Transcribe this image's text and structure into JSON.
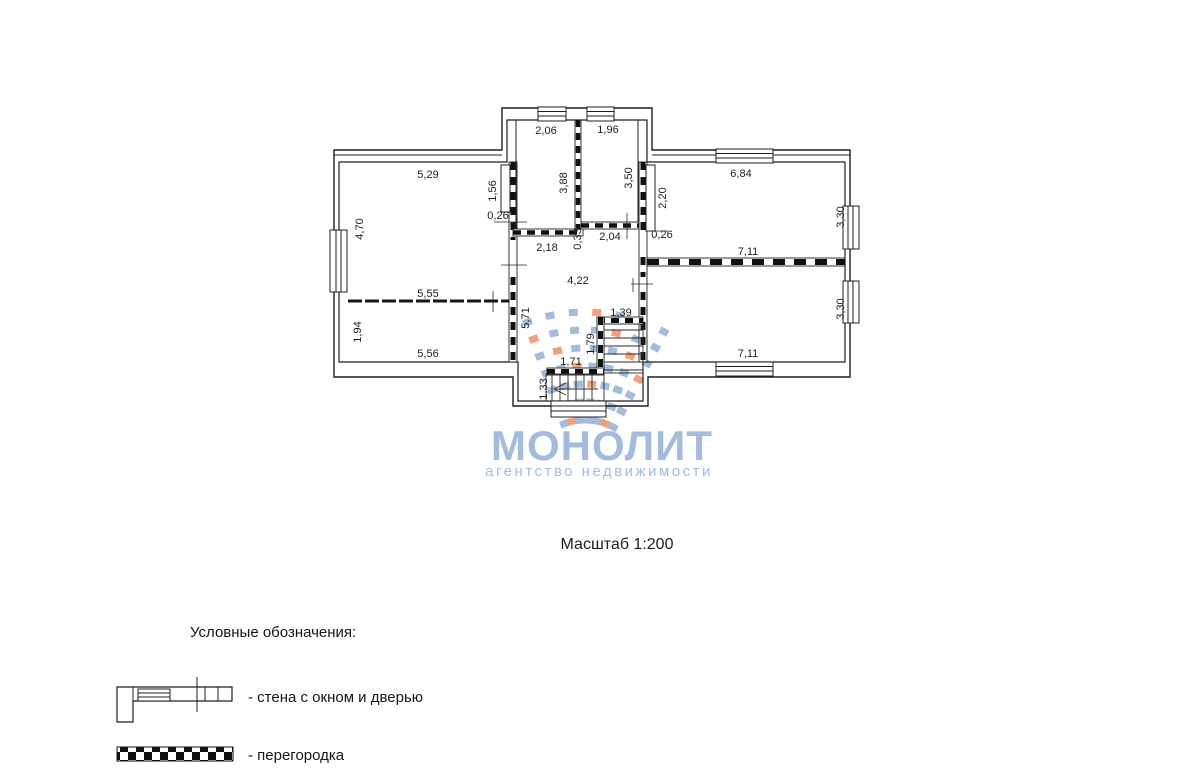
{
  "scale_label": "Масштаб 1:200",
  "watermark": {
    "brand": "МОНОЛИТ",
    "tagline": "агентство недвижимости",
    "blue": "#a4bbdc",
    "orange": "#f0a07a",
    "logo": {
      "cx": 585,
      "cy": 480,
      "angles": [
        -20,
        -12,
        -4,
        4,
        12,
        20,
        28
      ],
      "radii": [
        60,
        78,
        96,
        114,
        132,
        150,
        168
      ],
      "tile_w": 9,
      "tile_h": 7,
      "orange_every": 4
    }
  },
  "legend": {
    "heading": "Условные обозначения:",
    "items": [
      {
        "symbol": "wall-with-window-and-door",
        "label": "- стена с окном и дверью"
      },
      {
        "symbol": "partition",
        "label": "- перегородка"
      }
    ]
  },
  "plan": {
    "dims": [
      {
        "t": "5,29"
      },
      {
        "t": "2,06"
      },
      {
        "t": "1,96"
      },
      {
        "t": "6,84"
      },
      {
        "t": "4,70"
      },
      {
        "t": "1,56"
      },
      {
        "t": "3,88"
      },
      {
        "t": "3,50"
      },
      {
        "t": "2,20"
      },
      {
        "t": "3,30"
      },
      {
        "t": "0,26"
      },
      {
        "t": "0,33"
      },
      {
        "t": "2,18"
      },
      {
        "t": "2,04"
      },
      {
        "t": "0,26"
      },
      {
        "t": "7,11"
      },
      {
        "t": "4,22"
      },
      {
        "t": "5,55"
      },
      {
        "t": "5,71"
      },
      {
        "t": "1,39"
      },
      {
        "t": "1,79"
      },
      {
        "t": "1,71"
      },
      {
        "t": "1,94"
      },
      {
        "t": "1,33"
      },
      {
        "t": "5,56"
      },
      {
        "t": "7,11"
      },
      {
        "t": "3,30"
      }
    ]
  }
}
